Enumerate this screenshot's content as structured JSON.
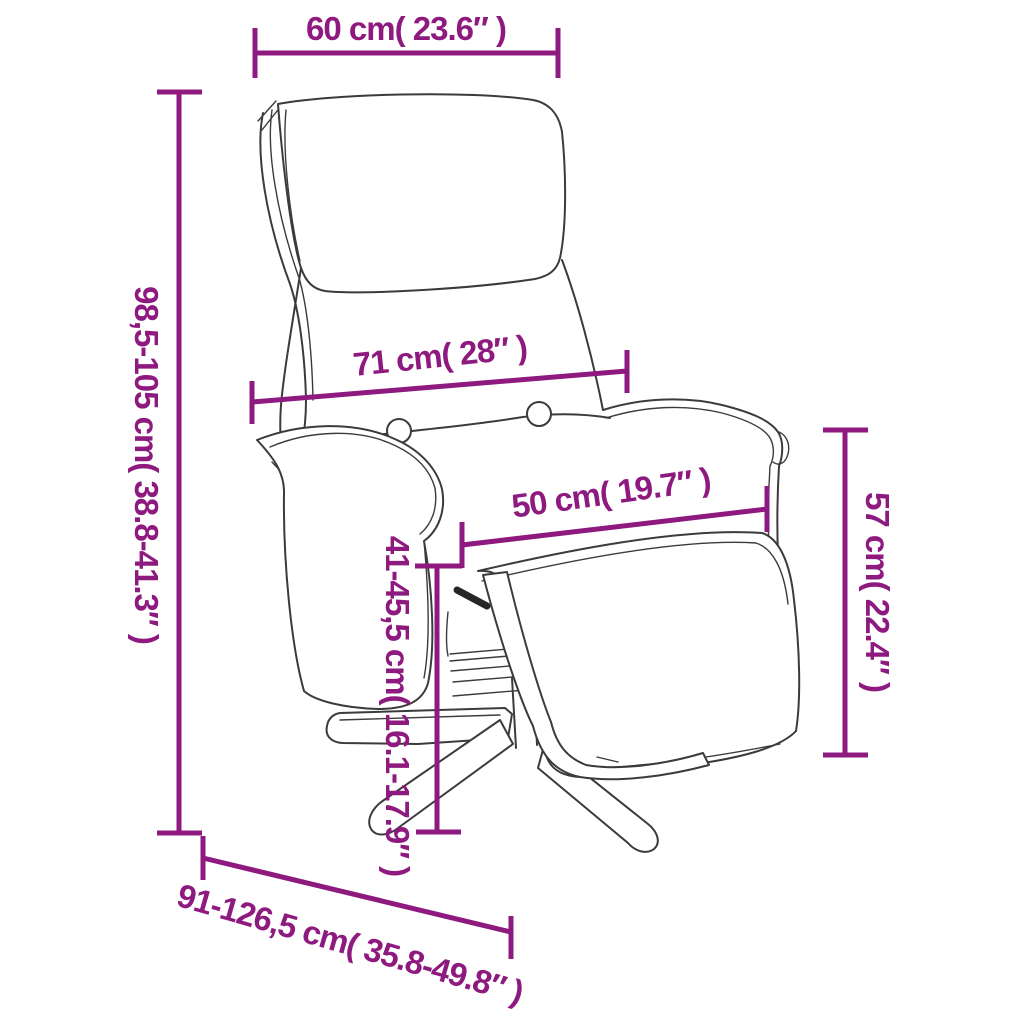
{
  "diagram": {
    "title": "Recliner chair with footrest - dimension diagram",
    "accent_color": "#8E1A80",
    "line_color": "#3b3b3b",
    "background_color": "#ffffff",
    "unit_system": "cm / inches",
    "dims": {
      "headrest_width": {
        "label": "60 cm( 23.6″ )",
        "cm": "60",
        "inch": "23.6"
      },
      "total_height": {
        "label": "98,5-105 cm( 38.8-41.3″ )",
        "cm": "98,5-105",
        "inch": "38.8-41.3"
      },
      "back_width": {
        "label": "71 cm( 28″ )",
        "cm": "71",
        "inch": "28"
      },
      "footrest_width": {
        "label": "50 cm( 19.7″ )",
        "cm": "50",
        "inch": "19.7"
      },
      "armrest_height": {
        "label": "57 cm( 22.4″ )",
        "cm": "57",
        "inch": "22.4"
      },
      "seat_height": {
        "label": "41-45,5 cm( 16.1-17.9″ )",
        "cm": "41-45,5",
        "inch": "16.1-17.9"
      },
      "depth": {
        "label": "91-126,5 cm( 35.8-49.8″ )",
        "cm": "91-126,5",
        "inch": "35.8-49.8"
      }
    }
  }
}
